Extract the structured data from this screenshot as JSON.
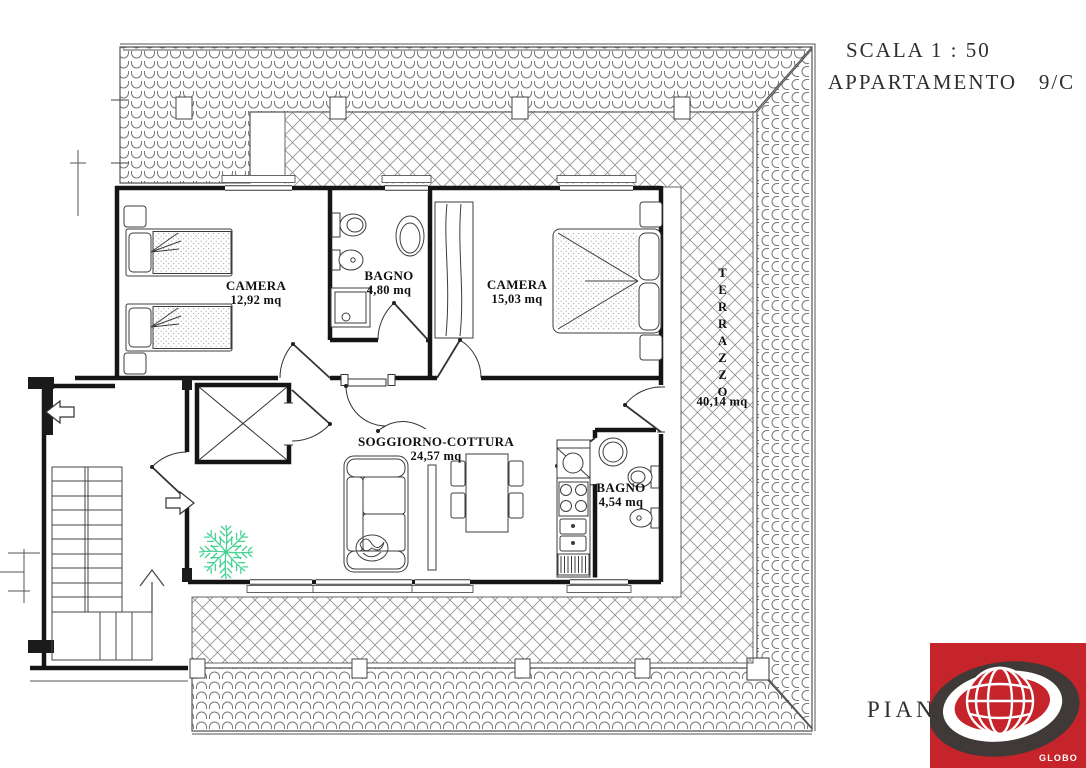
{
  "header": {
    "scale_label": "SCALA 1 : 50",
    "apartment_label": "APPARTAMENTO   9/C"
  },
  "rooms": [
    {
      "name": "CAMERA",
      "area": "12,92 mq"
    },
    {
      "name": "BAGNO",
      "area": "4,80 mq"
    },
    {
      "name": "CAMERA",
      "area": "15,03 mq"
    },
    {
      "name": "SOGGIORNO-COTTURA",
      "area": "24,57 mq"
    },
    {
      "name": "BAGNO",
      "area": "4,54 mq"
    },
    {
      "name": "TERRAZZO",
      "area": "40,14 mq"
    }
  ],
  "footer": {
    "floor_label": "PIANO",
    "logo_text": "GLOBO"
  },
  "colors": {
    "plant_green": "#45d193",
    "logo_red": "#c5242b",
    "logo_dark": "#3f3a37",
    "ink": "#2f2f2f"
  }
}
